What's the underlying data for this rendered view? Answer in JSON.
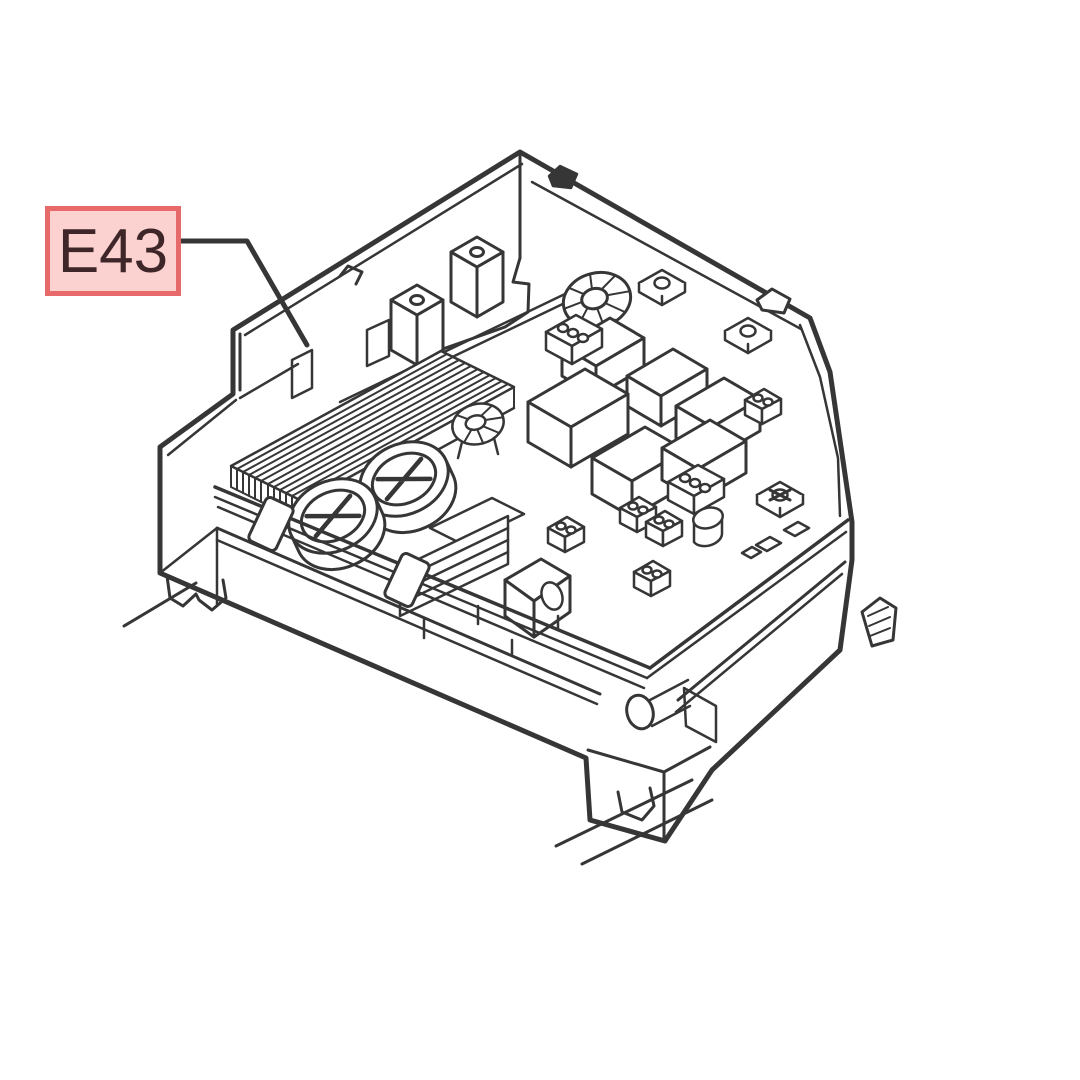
{
  "callout": {
    "label": "E43"
  },
  "colors": {
    "background": "#ffffff",
    "ink": "#363636",
    "callout_fill": "#fbd2d0",
    "callout_border": "#e8696a",
    "callout_text": "#3f2628"
  }
}
